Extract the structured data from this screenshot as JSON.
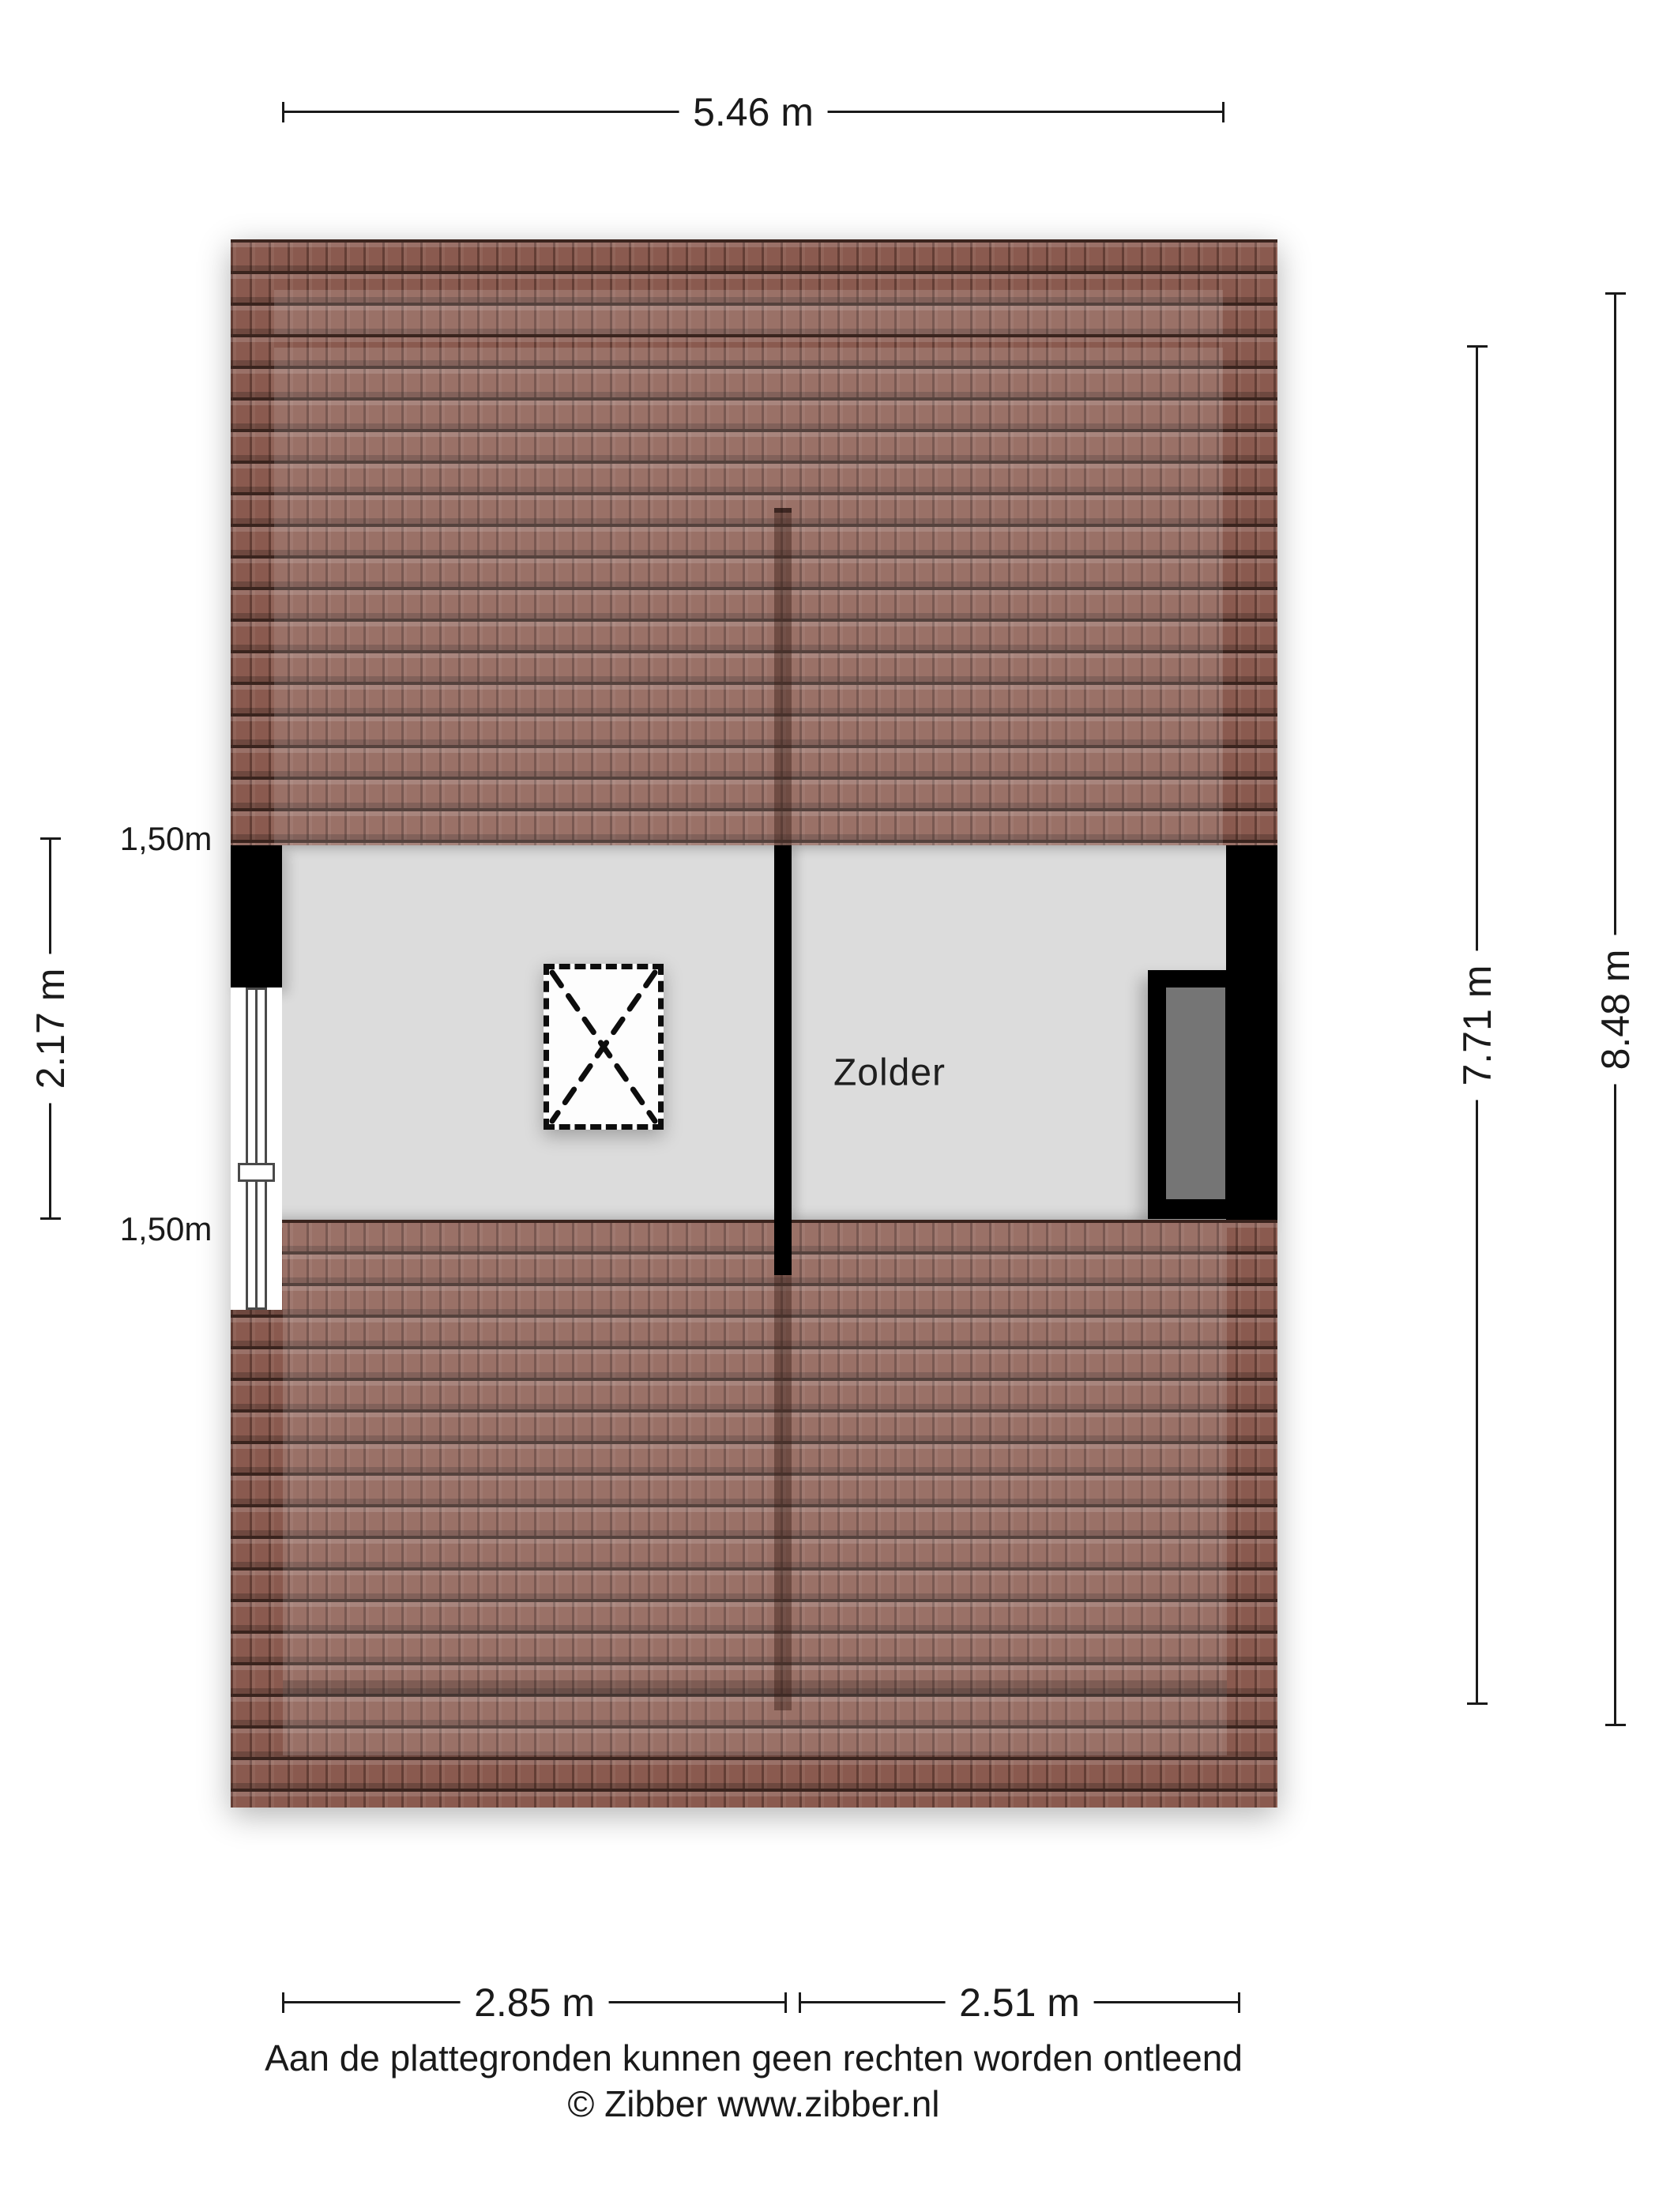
{
  "room": {
    "label": "Zolder"
  },
  "dimensions": {
    "width_total": "5.46 m",
    "height_right_outer": "8.48 m",
    "height_right_inner": "7.71 m",
    "height_left": "2.17 m",
    "knee_wall_top": "1,50m",
    "knee_wall_bottom": "1,50m",
    "bottom_left_room": "2.85 m",
    "bottom_right_room": "2.51 m"
  },
  "footer": {
    "disclaimer": "Aan de plattegronden kunnen geen rechten worden ontleend",
    "copyright": "© Zibber www.zibber.nl"
  },
  "colors": {
    "background": "#ffffff",
    "roof-base": "#8a5a4f",
    "roof-line": "#3a241e",
    "floor": "#dcdcdc",
    "wall": "#000000",
    "dormer-glass": "#757575",
    "dim": "#1a1a1a"
  }
}
